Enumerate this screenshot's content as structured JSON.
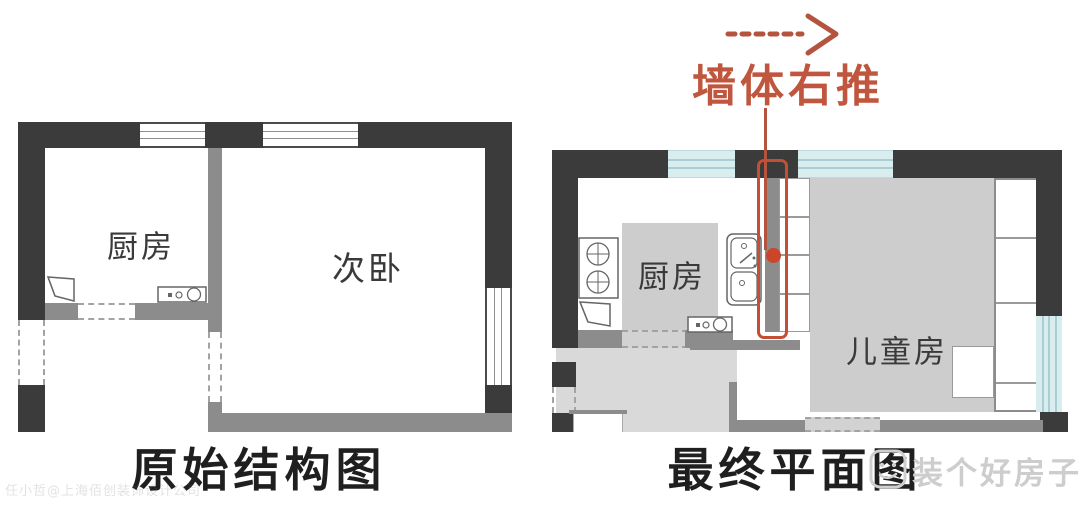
{
  "left_plan": {
    "title": "原始结构图",
    "rooms": {
      "kitchen": "厨房",
      "bedroom": "次卧"
    }
  },
  "right_plan": {
    "title": "最终平面图",
    "rooms": {
      "kitchen": "厨房",
      "kids_room": "儿童房"
    }
  },
  "annotation": {
    "text": "墙体右推",
    "arrow_icon": "dashed-right-arrow",
    "color": "#c0563e"
  },
  "watermarks": {
    "brand": "装个好房子",
    "brand_logo_icon": "smiley-face",
    "credit": "任小哲@上海佰创装饰设计公司"
  },
  "icons": {
    "stove": "two-burner-stove",
    "sink": "double-basin-sink",
    "door": "door-leaf",
    "washer": "washing-machine"
  },
  "colors": {
    "wall_dark": "#3b3b3b",
    "wall_gray": "#8c8c8c",
    "furniture_gray": "#cdcdcd",
    "floor_gray": "#d9d9d9",
    "window_blue": "#d9ecee",
    "accent_red": "#c0563e"
  }
}
